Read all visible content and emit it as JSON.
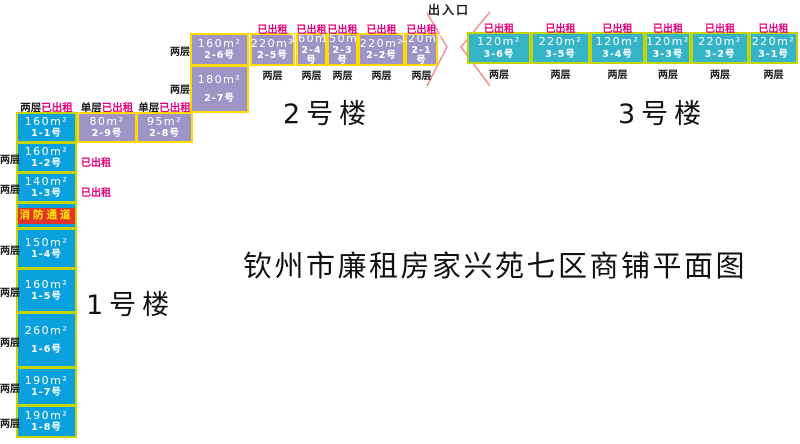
{
  "title": "钦州市廉租房家兴苑七区商铺平面图",
  "labels": {
    "entrance": "出入口",
    "fire_passage": "消防通道",
    "rented": "已出租",
    "two_floors": "两层",
    "single_floor": "单层"
  },
  "colors": {
    "building1_fill": "#0aa1de",
    "building2_fill": "#9d95c6",
    "building3_fill": "#35b4c8",
    "cell_border_green_yellow": "#c3d400",
    "cell_border_yellow": "#ffd900",
    "rented_magenta": "#e6007e",
    "fire_red": "#e5352b",
    "fire_text_yellow": "#ffe800",
    "gate_line_pink": "#ef8a8a"
  },
  "building1": {
    "name": "1号楼",
    "units": [
      {
        "area": "160m²",
        "no": "1-1号",
        "floors": "两层",
        "rented": true
      },
      {
        "area": "160m²",
        "no": "1-2号",
        "floors": "两层",
        "rented": true
      },
      {
        "area": "140m²",
        "no": "1-3号",
        "floors": "两层",
        "rented": true
      },
      {
        "area": "150m²",
        "no": "1-4号",
        "floors": "两层",
        "rented": false
      },
      {
        "area": "160m²",
        "no": "1-5号",
        "floors": "两层",
        "rented": false
      },
      {
        "area": "260m²",
        "no": "1-6号",
        "floors": "两层",
        "rented": false
      },
      {
        "area": "190m²",
        "no": "1-7号",
        "floors": "两层",
        "rented": false
      },
      {
        "area": "190m²",
        "no": "1-8号",
        "floors": "两层",
        "rented": false
      }
    ]
  },
  "building2": {
    "name": "2号楼",
    "units": [
      {
        "area": "80m²",
        "no": "2-9号",
        "floors": "单层",
        "rented": true
      },
      {
        "area": "95m²",
        "no": "2-8号",
        "floors": "单层",
        "rented": true
      },
      {
        "area": "180m²",
        "no": "2-7号",
        "floors": "两层",
        "rented": false
      },
      {
        "area": "160m²",
        "no": "2-6号",
        "floors": "两层",
        "rented": false
      },
      {
        "area": "220m²",
        "no": "2-5号",
        "floors": "两层",
        "rented": true
      },
      {
        "area": "160m²",
        "no": "2-4号",
        "floors": "两层",
        "rented": true
      },
      {
        "area": "150m²",
        "no": "2-3号",
        "floors": "两层",
        "rented": true
      },
      {
        "area": "220m²",
        "no": "2-2号",
        "floors": "两层",
        "rented": true
      },
      {
        "area": "120m²",
        "no": "2-1号",
        "floors": "两层",
        "rented": true
      }
    ]
  },
  "building3": {
    "name": "3号楼",
    "units": [
      {
        "area": "120m²",
        "no": "3-6号",
        "floors": "两层",
        "rented": true
      },
      {
        "area": "220m²",
        "no": "3-5号",
        "floors": "两层",
        "rented": true
      },
      {
        "area": "120m²",
        "no": "3-4号",
        "floors": "两层",
        "rented": true
      },
      {
        "area": "120m²",
        "no": "3-3号",
        "floors": "两层",
        "rented": true
      },
      {
        "area": "220m²",
        "no": "3-2号",
        "floors": "两层",
        "rented": true
      },
      {
        "area": "220m²",
        "no": "3-1号",
        "floors": "两层",
        "rented": true
      }
    ]
  }
}
